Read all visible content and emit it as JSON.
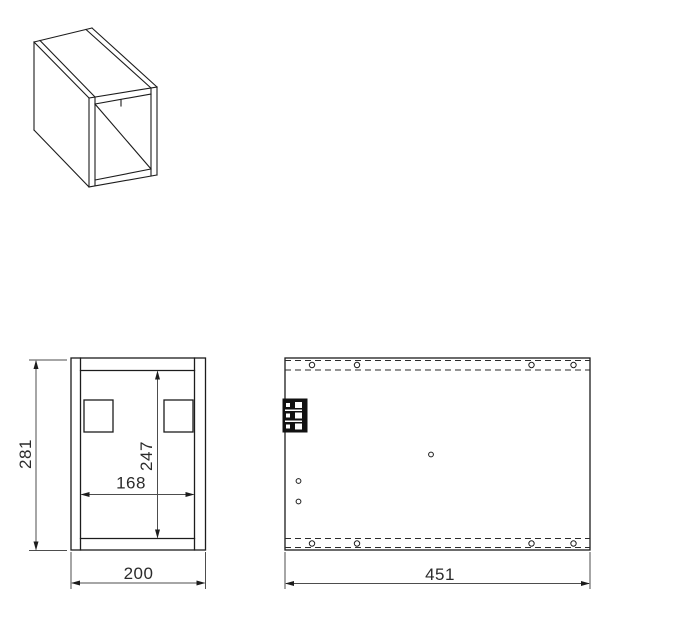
{
  "drawing": {
    "background_color": "#ffffff",
    "geometry_line_color": "#1c1c1c",
    "dimension_line_color": "#4d4d4d",
    "text_color": "#2b2b2b"
  },
  "front_view": {
    "overall_height": "281",
    "inner_height": "247",
    "inner_width": "168",
    "overall_width": "200"
  },
  "side_view": {
    "overall_width": "451"
  }
}
